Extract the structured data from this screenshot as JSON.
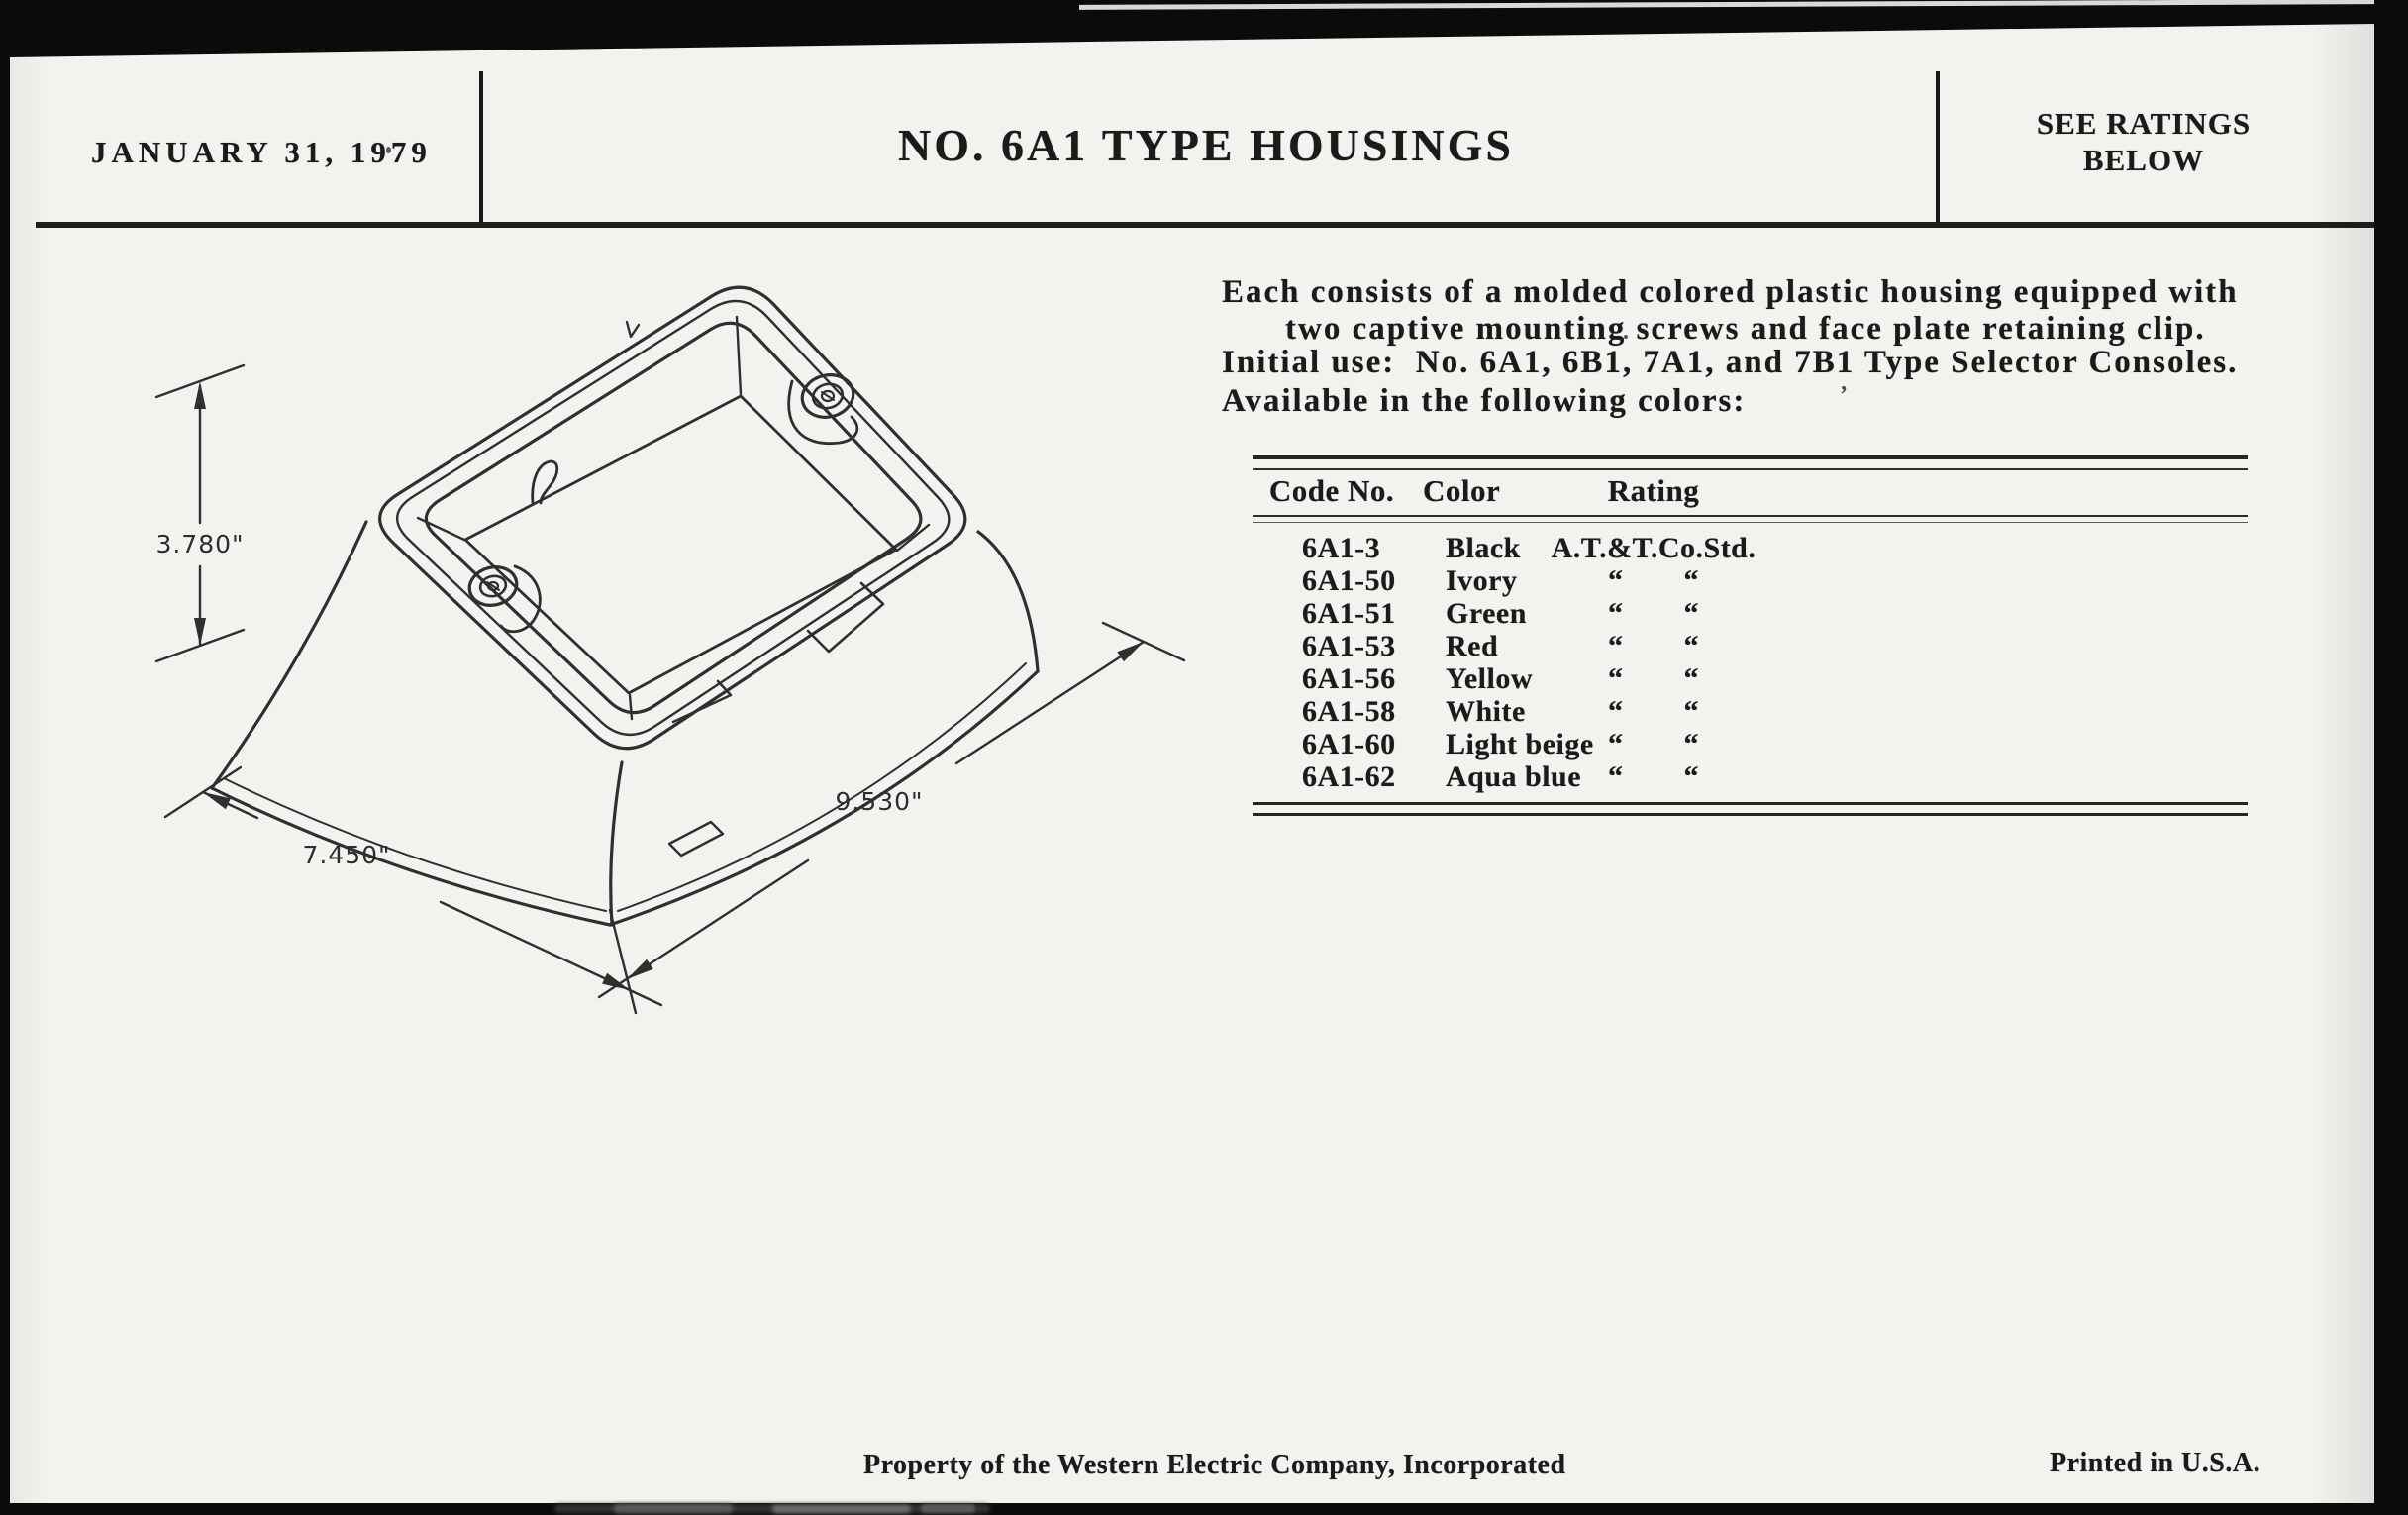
{
  "header": {
    "date": "JANUARY 31, 1979",
    "title": "NO. 6A1 TYPE HOUSINGS",
    "note_line1": "SEE RATINGS",
    "note_line2": "BELOW"
  },
  "intro": {
    "line1": "Each consists of a molded colored plastic housing equipped with",
    "line2": "two captive mounting screws and face plate retaining clip.",
    "line3": "Initial use:  No. 6A1, 6B1, 7A1, and 7B1 Type Selector Consoles.",
    "line4": "Available in the following colors:"
  },
  "drawing": {
    "dim_height": "3.780\"",
    "dim_depth": "7.450\"",
    "dim_width": "9.530\""
  },
  "table": {
    "headers": {
      "code": "Code No.",
      "color": "Color",
      "rating": "Rating"
    },
    "rows": [
      {
        "code": "6A1-3",
        "color": "Black",
        "rating": "A.T.&T.Co.Std."
      },
      {
        "code": "6A1-50",
        "color": "Ivory",
        "rating": "“  “"
      },
      {
        "code": "6A1-51",
        "color": "Green",
        "rating": "“  “"
      },
      {
        "code": "6A1-53",
        "color": "Red",
        "rating": "“  “"
      },
      {
        "code": "6A1-56",
        "color": "Yellow",
        "rating": "“  “"
      },
      {
        "code": "6A1-58",
        "color": "White",
        "rating": "“  “"
      },
      {
        "code": "6A1-60",
        "color": "Light beige",
        "rating": "“  “"
      },
      {
        "code": "6A1-62",
        "color": "Aqua blue",
        "rating": "“  “"
      }
    ]
  },
  "footer": {
    "left": "Property of the Western Electric Company, Incorporated",
    "right": "Printed in U.S.A."
  }
}
